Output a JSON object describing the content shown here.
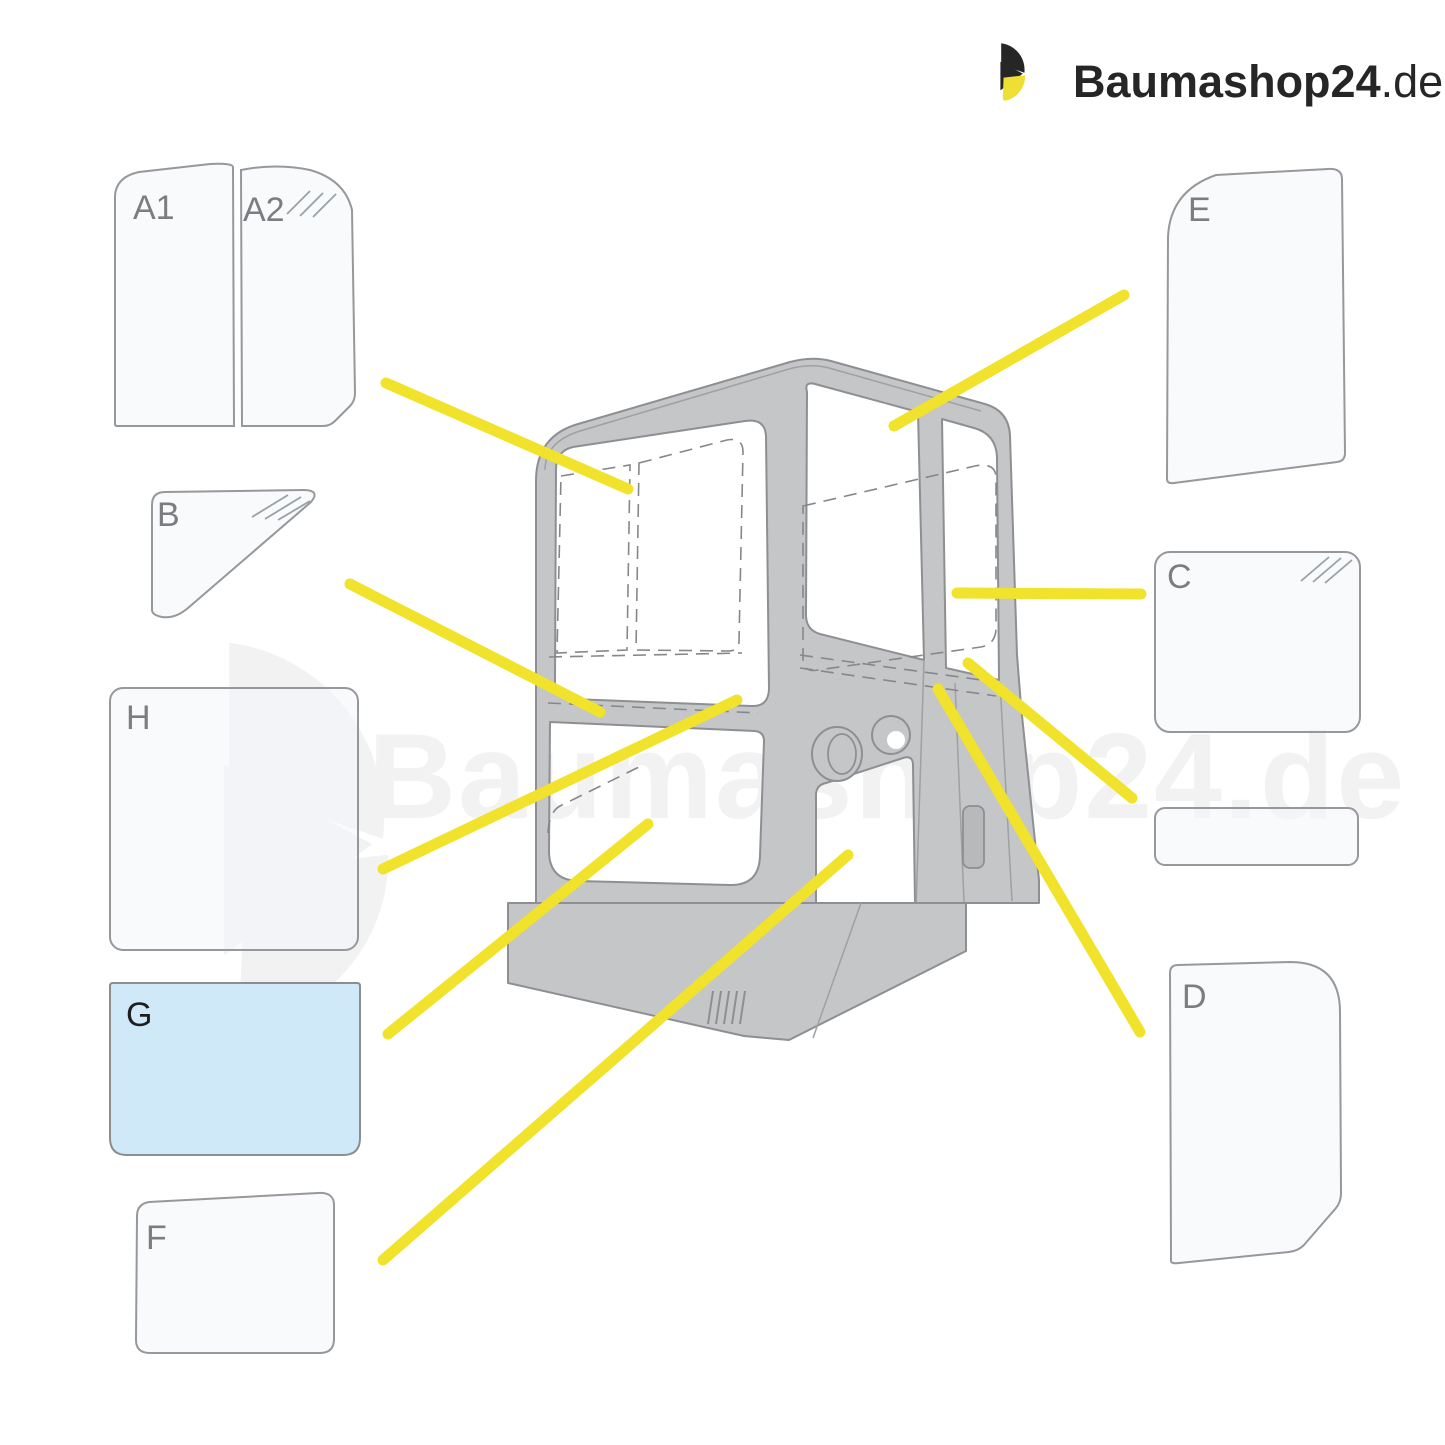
{
  "brand": {
    "logo_main": "Baumashop",
    "logo_number": "24",
    "logo_tld": ".de",
    "color_dark": "#262626",
    "color_yellow": "#f0df33"
  },
  "watermark": {
    "text": "Baumashop24.de"
  },
  "diagram": {
    "subject": "Excavator cab glazing parts diagram",
    "accent_line_color": "#f1e22b",
    "cab_fill": "#c4c6c8",
    "glass_fill": "#f4f7fa",
    "tinted_panel_color": "#cfe9f8",
    "panels": [
      {
        "id": "A1",
        "label": "A1",
        "hatched": false,
        "tinted": false
      },
      {
        "id": "A2",
        "label": "A2",
        "hatched": true,
        "tinted": false
      },
      {
        "id": "B",
        "label": "B",
        "hatched": true,
        "tinted": false
      },
      {
        "id": "H",
        "label": "H",
        "hatched": false,
        "tinted": false
      },
      {
        "id": "G",
        "label": "G",
        "hatched": false,
        "tinted": true
      },
      {
        "id": "F",
        "label": "F",
        "hatched": false,
        "tinted": false
      },
      {
        "id": "E",
        "label": "E",
        "hatched": false,
        "tinted": false
      },
      {
        "id": "C",
        "label": "C",
        "hatched": true,
        "tinted": false
      },
      {
        "id": "strip",
        "label": "",
        "hatched": false,
        "tinted": false
      },
      {
        "id": "D",
        "label": "D",
        "hatched": false,
        "tinted": false
      }
    ]
  }
}
